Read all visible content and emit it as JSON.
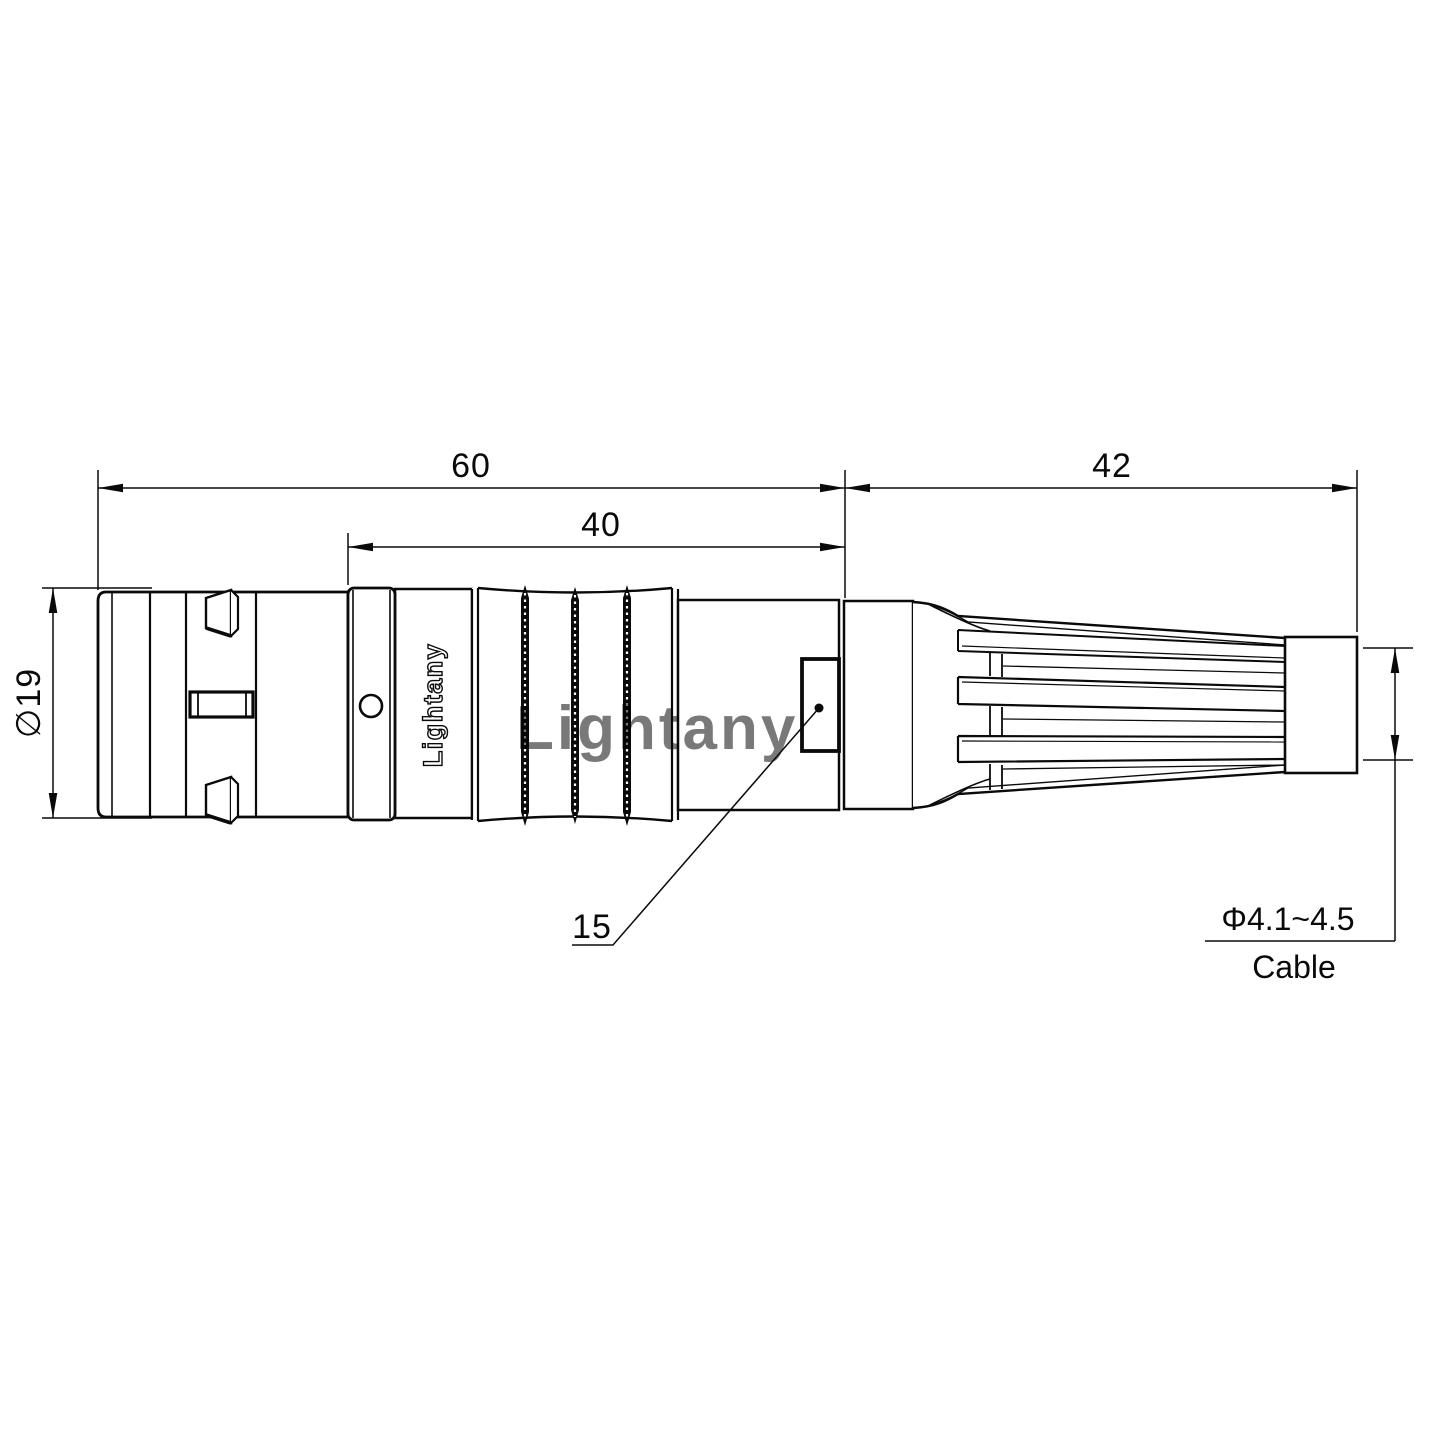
{
  "page": {
    "background": "#ffffff",
    "line_color": "#0a0a0a"
  },
  "branding": {
    "body_text": "Lightany",
    "watermark_text": "Lightany",
    "watermark_color": "#eda9a9"
  },
  "dims": {
    "total": {
      "value": "60"
    },
    "grip": {
      "value": "40"
    },
    "boot": {
      "value": "42"
    },
    "diameter": {
      "value": "∅19"
    },
    "window": {
      "value": "15"
    },
    "cable": {
      "spec": "Φ4.1~4.5",
      "label": "Cable"
    }
  }
}
